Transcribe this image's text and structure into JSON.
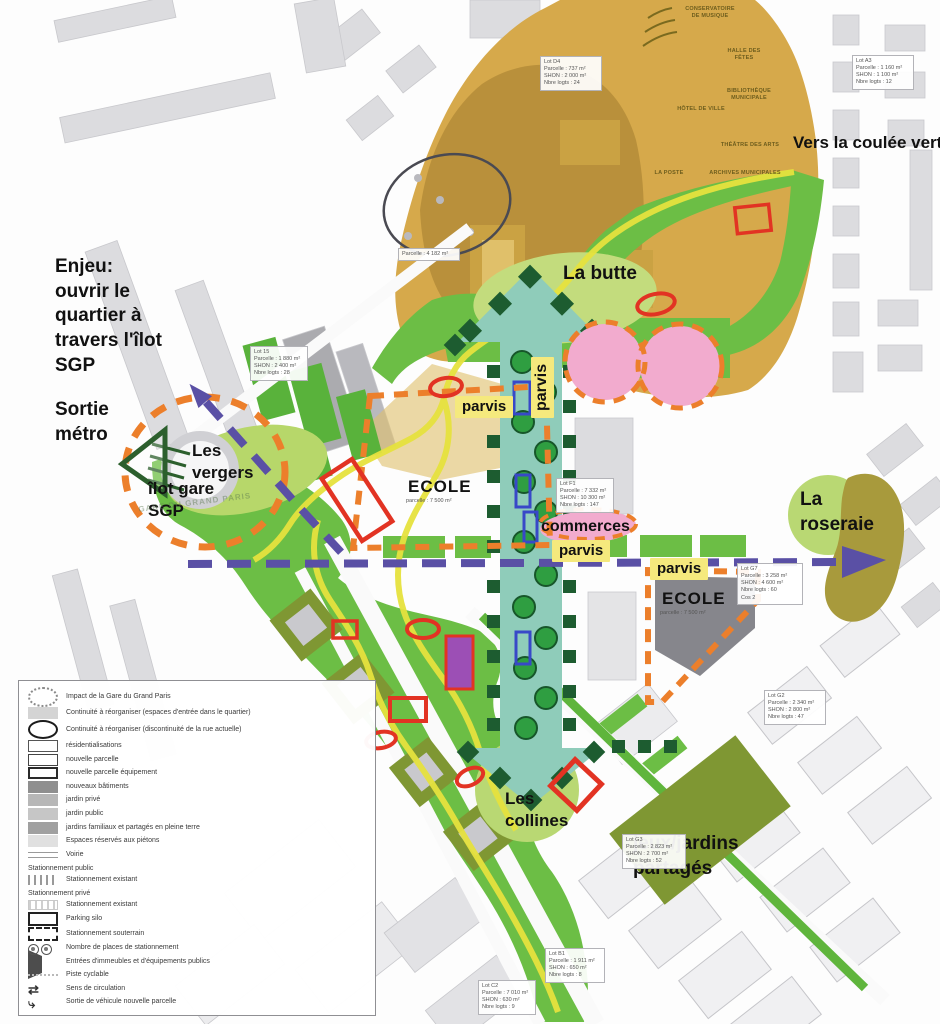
{
  "labels": {
    "vers_coulee_verte": "Vers la coulée verte",
    "enjeu": "Enjeu:\nouvrir le\nquartier à\ntravers l'îlot\nSGP",
    "sortie_metro": "Sortie\nmétro",
    "les_vergers": "Les\nvergers",
    "ilot_gare_sgp": "îlot gare\nSGP",
    "la_butte": "La butte",
    "parvis": "parvis",
    "commerces": "commerces",
    "ecole": "ECOLE",
    "ecole_parcelle": "parcelle : 7 500 m²",
    "la_roseraie": "La\nroseraie",
    "les_collines": "Les\ncollines",
    "jeux_jardins": "jeux/jardins\npartagés",
    "gare_ghost": "GARE DU GRAND PARIS"
  },
  "facilities": {
    "conservatoire": "Conservatoire\nde musique",
    "halle": "Halle des\nfêtes",
    "bibliotheque": "Bibliothèque\nmunicipale",
    "hotel_de_ville": "Hôtel de ville",
    "theatre": "Théâtre des arts",
    "poste": "La poste",
    "archives": "Archives municipales"
  },
  "legend": {
    "items": [
      {
        "label": "Impact de la Gare du Grand Paris"
      },
      {
        "label": "Continuité à réorganiser (espaces d'entrée dans le quartier)"
      },
      {
        "label": "Continuité à réorganiser (discontinuité de la rue actuelle)"
      },
      {
        "label": "résidentialisations"
      },
      {
        "label": "nouvelle parcelle"
      },
      {
        "label": "nouvelle parcelle équipement"
      },
      {
        "label": "nouveaux bâtiments"
      },
      {
        "label": "jardin privé"
      },
      {
        "label": "jardin public"
      },
      {
        "label": "jardins familiaux et partagés en pleine terre"
      },
      {
        "label": "Espaces réservés aux piétons"
      },
      {
        "label": "Voirie"
      },
      {
        "label": "Stationnement existant"
      },
      {
        "label": "Stationnement existant"
      },
      {
        "label": "Parking silo"
      },
      {
        "label": "Stationnement souterrain"
      },
      {
        "label": "Nombre de places de stationnement"
      },
      {
        "label": "Entrées d'immeubles et d'équipements publics"
      },
      {
        "label": "Piste cyclable"
      },
      {
        "label": "Sens de circulation"
      },
      {
        "label": "Sortie de véhicule nouvelle parcelle"
      }
    ],
    "header_public": "Stationnement public",
    "header_prive": "Stationnement privé"
  },
  "icons": {
    "sens_glyph": "⇄",
    "sortie_glyph": "⤷"
  },
  "parcels": [
    {
      "text": "Lot G7\nParcelle : 3 258 m²\nSHON : 4 600 m²\nNbre logts : 60\nCos 2"
    },
    {
      "text": "Lot F1\nParcelle : 7 332 m²\nSHON : 10 300 m²\nNbre logts : 147"
    },
    {
      "text": "Lot G2\nParcelle : 2 340 m²\nSHON : 2 800 m²\nNbre logts : 47"
    },
    {
      "text": "Lot 15\nParcelle : 1 880 m²\nSHON : 2 400 m²\nNbre logts : 28"
    },
    {
      "text": "Parcelle : 4 182 m²"
    },
    {
      "text": "Lot G3\nParcelle : 2 823 m²\nSHON : 2 700 m²\nNbre logts : 52"
    },
    {
      "text": "Lot B1\nParcelle : 1 911 m²\nSHON : 650 m²\nNbre logts : 8"
    },
    {
      "text": "Lot C2\nParcelle : 7 010 m²\nSHON : 630 m²\nNbre logts : 9"
    },
    {
      "text": "Lot A3\nParcelle : 1 160 m²\nSHON : 1 100 m²\nNbre logts : 12"
    },
    {
      "text": "Lot D4\nParcelle : 737 m²\nSHON : 2 000 m²\nNbre logts : 24"
    }
  ],
  "colors": {
    "ochre_zone": "#d6a94b",
    "ochre_dark": "#b9903b",
    "park_green": "#6cbe45",
    "light_green": "#c3dc7d",
    "teal_corridor": "#8fccba",
    "dark_green": "#1d5c30",
    "tree_green": "#2f9e41",
    "yellow_path": "#e6e23e",
    "purple_axis": "#5a50a5",
    "orange_dash": "#ec7f2b",
    "red_mark": "#e23323",
    "pink_zone": "#f2abce",
    "olive_blob": "#a89a3c",
    "label_yellow": "#f5e97d"
  }
}
